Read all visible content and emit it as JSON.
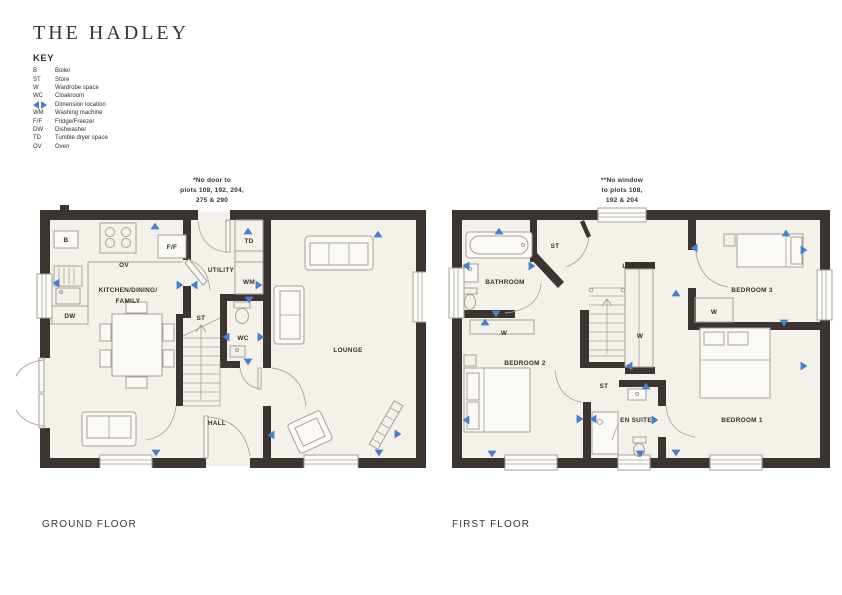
{
  "page": {
    "title": "THE HADLEY"
  },
  "key": {
    "heading": "KEY",
    "items": [
      {
        "abbr": "B",
        "label": "Boiler"
      },
      {
        "abbr": "ST",
        "label": "Store"
      },
      {
        "abbr": "W",
        "label": "Wardrobe space"
      },
      {
        "abbr": "WC",
        "label": "Cloakroom"
      },
      {
        "abbr": "",
        "icon": "dimension-arrows-icon",
        "label": "Dimension location"
      },
      {
        "abbr": "WM",
        "label": "Washing machine"
      },
      {
        "abbr": "F/F",
        "label": "Fridge/Freezer"
      },
      {
        "abbr": "DW",
        "label": "Dishwasher"
      },
      {
        "abbr": "TD",
        "label": "Tumble dryer space"
      },
      {
        "abbr": "OV",
        "label": "Oven"
      }
    ]
  },
  "ground_floor": {
    "title": "GROUND FLOOR",
    "note_lines": [
      "*No door to",
      "plots 108, 192, 204,",
      "275 & 290"
    ],
    "labels": {
      "kitchen_line1": "KITCHEN/DINING/",
      "kitchen_line2": "FAMILY",
      "utility": "UTILITY",
      "lounge": "LOUNGE",
      "hall": "HALL",
      "wc": "WC",
      "store": "ST",
      "boiler": "B",
      "oven": "OV",
      "fridge_freezer": "F/F",
      "dishwasher": "DW",
      "tumble_dryer": "TD",
      "washing_machine": "WM"
    },
    "dimension_markers": [
      {
        "x": 115,
        "y": 16,
        "d": "up"
      },
      {
        "x": 16,
        "y": 73,
        "d": "left"
      },
      {
        "x": 140,
        "y": 75,
        "d": "right"
      },
      {
        "x": 154,
        "y": 75,
        "d": "left"
      },
      {
        "x": 219,
        "y": 75,
        "d": "right"
      },
      {
        "x": 208,
        "y": 21,
        "d": "up"
      },
      {
        "x": 209,
        "y": 90,
        "d": "down"
      },
      {
        "x": 186,
        "y": 127,
        "d": "left"
      },
      {
        "x": 221,
        "y": 127,
        "d": "right"
      },
      {
        "x": 208,
        "y": 152,
        "d": "down"
      },
      {
        "x": 116,
        "y": 243,
        "d": "down"
      },
      {
        "x": 338,
        "y": 24,
        "d": "up"
      },
      {
        "x": 231,
        "y": 225,
        "d": "left"
      },
      {
        "x": 358,
        "y": 224,
        "d": "right"
      },
      {
        "x": 339,
        "y": 243,
        "d": "down"
      }
    ]
  },
  "first_floor": {
    "title": "FIRST FLOOR",
    "note_lines": [
      "**No window",
      "to plots 108,",
      "192 & 204"
    ],
    "labels": {
      "bathroom": "BATHROOM",
      "landing": "LANDING",
      "bedroom3": "BEDROOM 3",
      "bedroom2": "BEDROOM 2",
      "bedroom1": "BEDROOM 1",
      "ensuite": "EN SUITE",
      "store_top": "ST",
      "store_mid": "ST",
      "wardrobe_bed2": "W",
      "wardrobe_center": "W",
      "wardrobe_bed3": "W"
    },
    "dimension_markers": [
      {
        "x": 47,
        "y": 21,
        "d": "up"
      },
      {
        "x": 14,
        "y": 56,
        "d": "left"
      },
      {
        "x": 80,
        "y": 56,
        "d": "right"
      },
      {
        "x": 44,
        "y": 104,
        "d": "down"
      },
      {
        "x": 33,
        "y": 112,
        "d": "up"
      },
      {
        "x": 224,
        "y": 83,
        "d": "up"
      },
      {
        "x": 242,
        "y": 38,
        "d": "left"
      },
      {
        "x": 334,
        "y": 23,
        "d": "up"
      },
      {
        "x": 352,
        "y": 40,
        "d": "right"
      },
      {
        "x": 332,
        "y": 113,
        "d": "down"
      },
      {
        "x": 352,
        "y": 156,
        "d": "right"
      },
      {
        "x": 14,
        "y": 210,
        "d": "left"
      },
      {
        "x": 40,
        "y": 244,
        "d": "down"
      },
      {
        "x": 177,
        "y": 156,
        "d": "left"
      },
      {
        "x": 194,
        "y": 176,
        "d": "up"
      },
      {
        "x": 203,
        "y": 210,
        "d": "right"
      },
      {
        "x": 188,
        "y": 244,
        "d": "down"
      },
      {
        "x": 224,
        "y": 243,
        "d": "down"
      },
      {
        "x": 128,
        "y": 209,
        "d": "right"
      },
      {
        "x": 141,
        "y": 209,
        "d": "left"
      }
    ]
  },
  "colors": {
    "wall": "#3c3431",
    "floor": "#f4f1ea",
    "furniture_line": "#a6a099",
    "dimension_arrow": "#4d7ec3",
    "text": "#332e2a"
  }
}
